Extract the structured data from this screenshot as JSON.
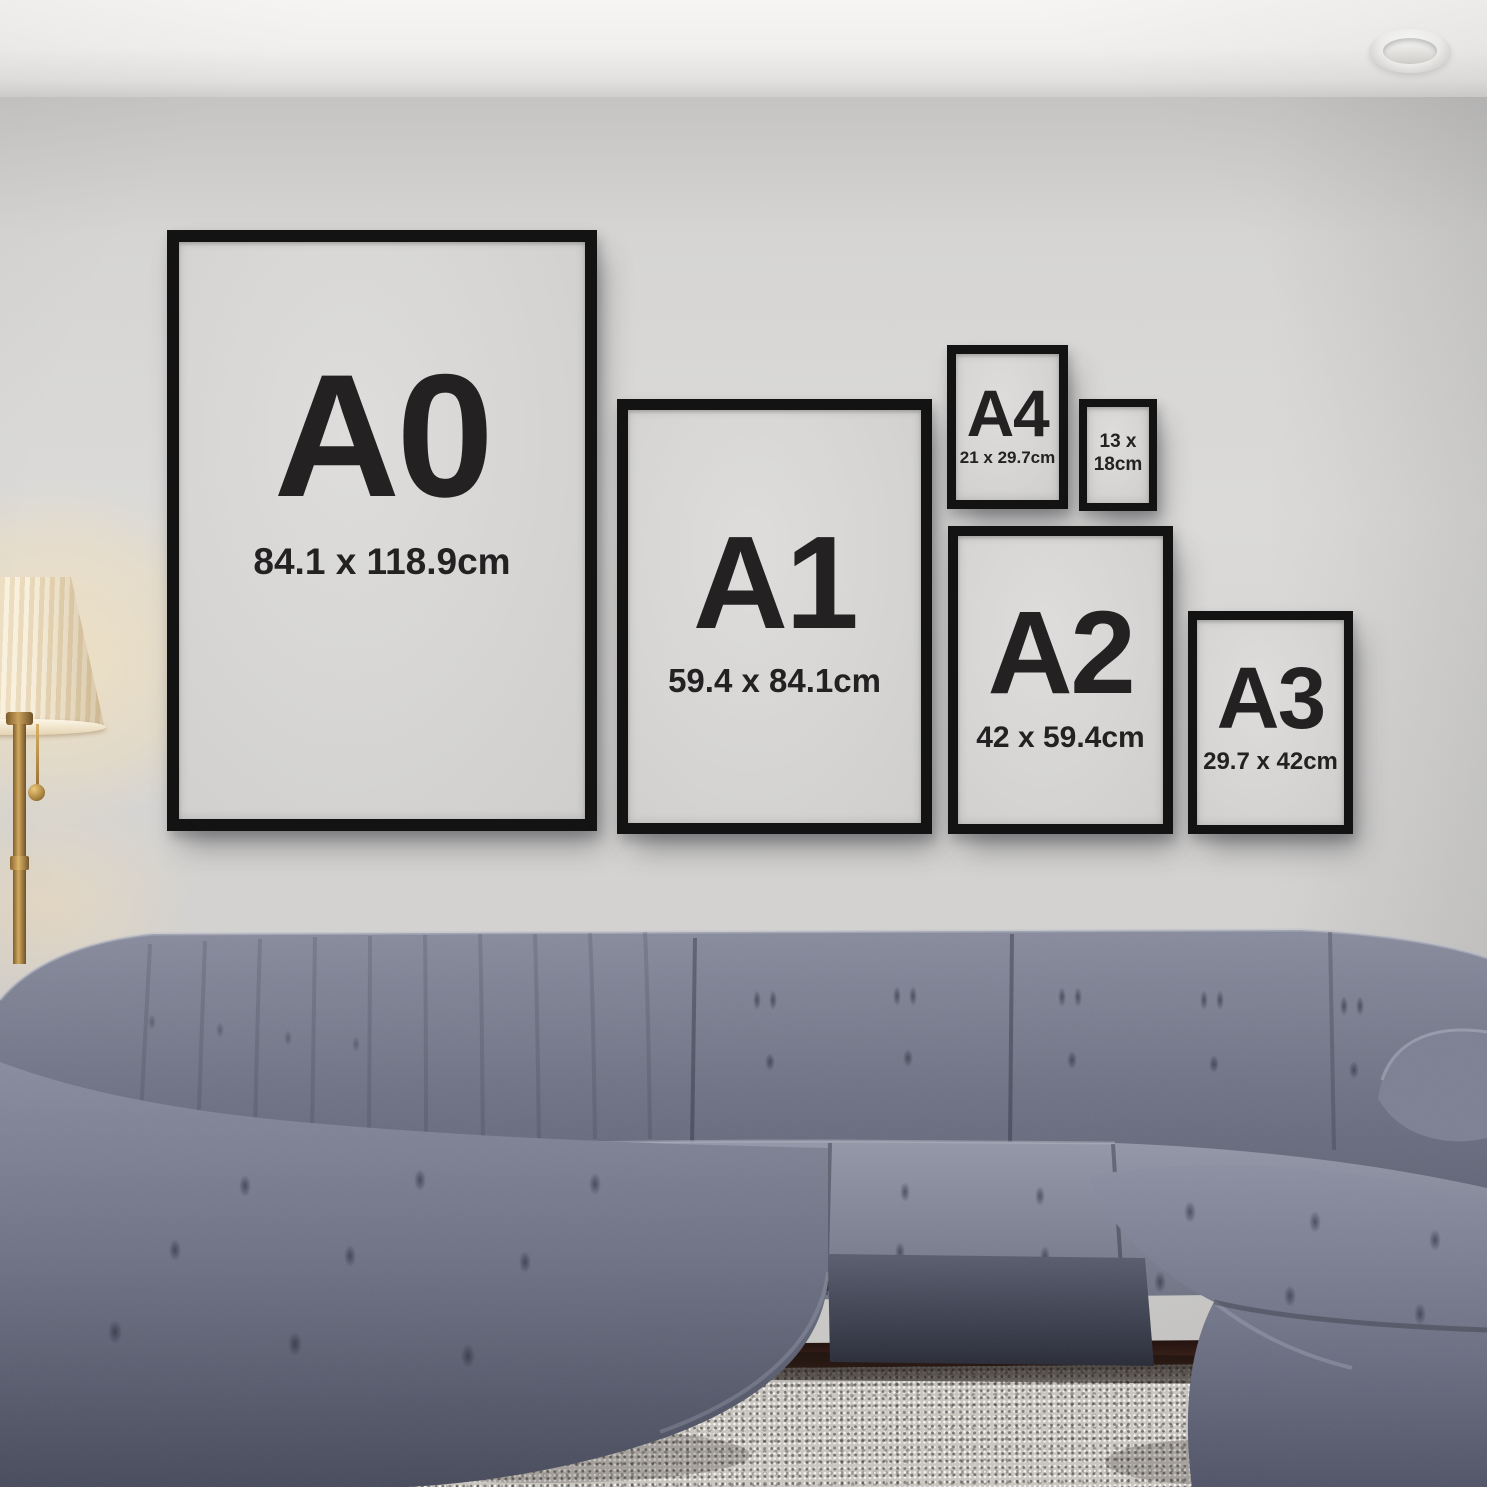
{
  "palette": {
    "wall": "#d6d5d3",
    "ceiling": "#f0efed",
    "frame": "#131313",
    "paper": "#d6d5d3",
    "ink": "#232122",
    "sofa": "#6d7183",
    "rug": "#c9c5bf",
    "floor": "#4c2d22",
    "shade": "#f8efdc",
    "brass": "#d2a95f",
    "glow": "#ffe7b4"
  },
  "frames": [
    {
      "name": "a0",
      "label": "A0",
      "dimensions": "84.1 x 118.9cm"
    },
    {
      "name": "a1",
      "label": "A1",
      "dimensions": "59.4 x 84.1cm"
    },
    {
      "name": "a4",
      "label": "A4",
      "dimensions": "21 x 29.7cm"
    },
    {
      "name": "size-13x18",
      "lines": [
        "13 x",
        "18cm"
      ]
    },
    {
      "name": "a2",
      "label": "A2",
      "dimensions": "42 x 59.4cm"
    },
    {
      "name": "a3",
      "label": "A3",
      "dimensions": "29.7 x 42cm"
    }
  ]
}
